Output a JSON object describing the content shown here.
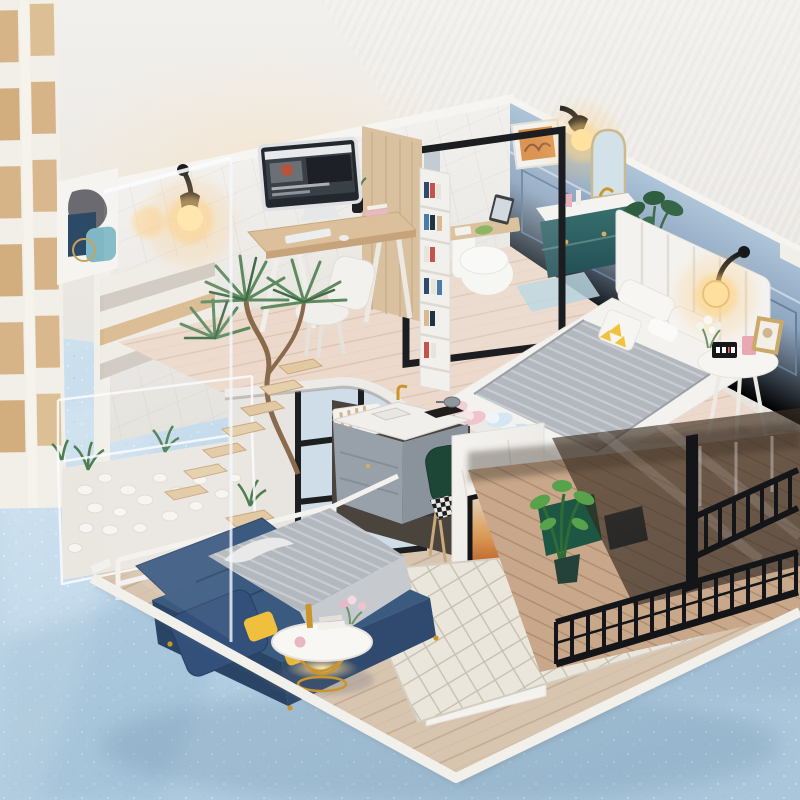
{
  "image": {
    "type": "product-photograph",
    "subject": "DIY miniature dollhouse — modern two-story loft apartment diorama",
    "setting": "diorama standing on a speckled light-blue surface against a white textured plaster wall, white wooden pallet rack at left edge"
  },
  "palette": {
    "wall_bg": "#ece9e5",
    "wall_warm": "#f7e4cc",
    "floor_blue": "#b7d2e6",
    "floor_blue_light": "#cfe2f0",
    "wood_light": "#dcc09b",
    "wood_dark": "#c6a37a",
    "loft_wood": "#ecd9cb",
    "navy": "#35547a",
    "navy_dark": "#2c4668",
    "navy_light": "#466a94",
    "grey_throw": "#b9bec4",
    "yellow": "#f0bf3e",
    "rug": "#eae6dc",
    "blue_wall": "#7f99b6",
    "blue_wall_light": "#a9c2d7",
    "teal": "#2d5c5f",
    "gold": "#c9962e",
    "black": "#17181a",
    "white": "#f4f2ee",
    "glow": "#ffd98c",
    "green": "#4e7d4f",
    "green_dark": "#2f5d3f",
    "green_bright": "#57a24b",
    "marble": "#f2f0ed",
    "screen_orange": "#cf7a3a",
    "screen_navy": "#2e3e58",
    "slipper_pink": "#f2cdd3",
    "slipper_blue": "#d6e5f2",
    "balcony_wood": "#c8a789",
    "kitchen_grey": "#98a1a9",
    "chair_green": "#1e4636",
    "pallet_wood": "#d6b488",
    "robot": "#eef0f2"
  },
  "scene": {
    "background": [
      "white plaster wall with diagonal trowel texture",
      "pale blue speckled floor with soft shadows"
    ],
    "props": [
      "white wooden pallet rack leaning at left"
    ],
    "upper_floor": {
      "office": [
        "black wall sconce with lit warm bulb",
        "iMac computer on wooden trestle desk",
        "white keyboard and mouse",
        "white desk chair",
        "black vase with green sprigs",
        "pink books",
        "abstract poster (grey blob, navy and teal shapes, gold ring)",
        "light wood wardrobe panel",
        "white bookshelf with colorful books",
        "clear acrylic front panel"
      ],
      "bathroom": [
        "white toilet with wooden tray, tablet and green plate",
        "teal vanity cabinet with marble top and gold knobs",
        "arched mirror",
        "framed orange artwork",
        "black sconce with lit bulb",
        "black-framed glass partition",
        "light blue bath mat"
      ],
      "bedroom": [
        "blue-grey paneled wall",
        "white channel-tufted headboard",
        "white duvet with grey knit throw",
        "white pillows and yellow triangle pillow",
        "black glass-globe sconce lit",
        "round nightstand with digital clock, pink box, photo frame and flowers",
        "potted monstera",
        "pink and blue fluffy slippers"
      ]
    },
    "lower_floor": {
      "living_room": [
        "navy blue sofa with grey knit throw and yellow pillows",
        "round white coffee table with gold wire base and warm under-glow",
        "diamond lattice rug",
        "white robot vacuum",
        "plank wood floor"
      ],
      "kitchen": [
        "grey island cabinets with white marble counter",
        "gold faucet and sink",
        "black cooktop with pot",
        "dark green velvet chair with checkered seat",
        "white console with magazine file",
        "dark fridge"
      ],
      "media_wall": [
        "white marble TV partition",
        "flat TV showing a sunset",
        "white TV cabinet",
        "wooden box",
        "plant in gold pot"
      ],
      "balcony": [
        "smoked glass panel",
        "black metal railing with corner post",
        "green-cloth table nook",
        "bright green potted plant",
        "diagonal plank floor"
      ]
    },
    "structure": [
      "floating wooden stair treads with white railing",
      "indoor white-pebble garden with curved-trunk palm",
      "curved white loft edge",
      "white-rimmed base platform",
      "black grid window behind stairs"
    ]
  }
}
